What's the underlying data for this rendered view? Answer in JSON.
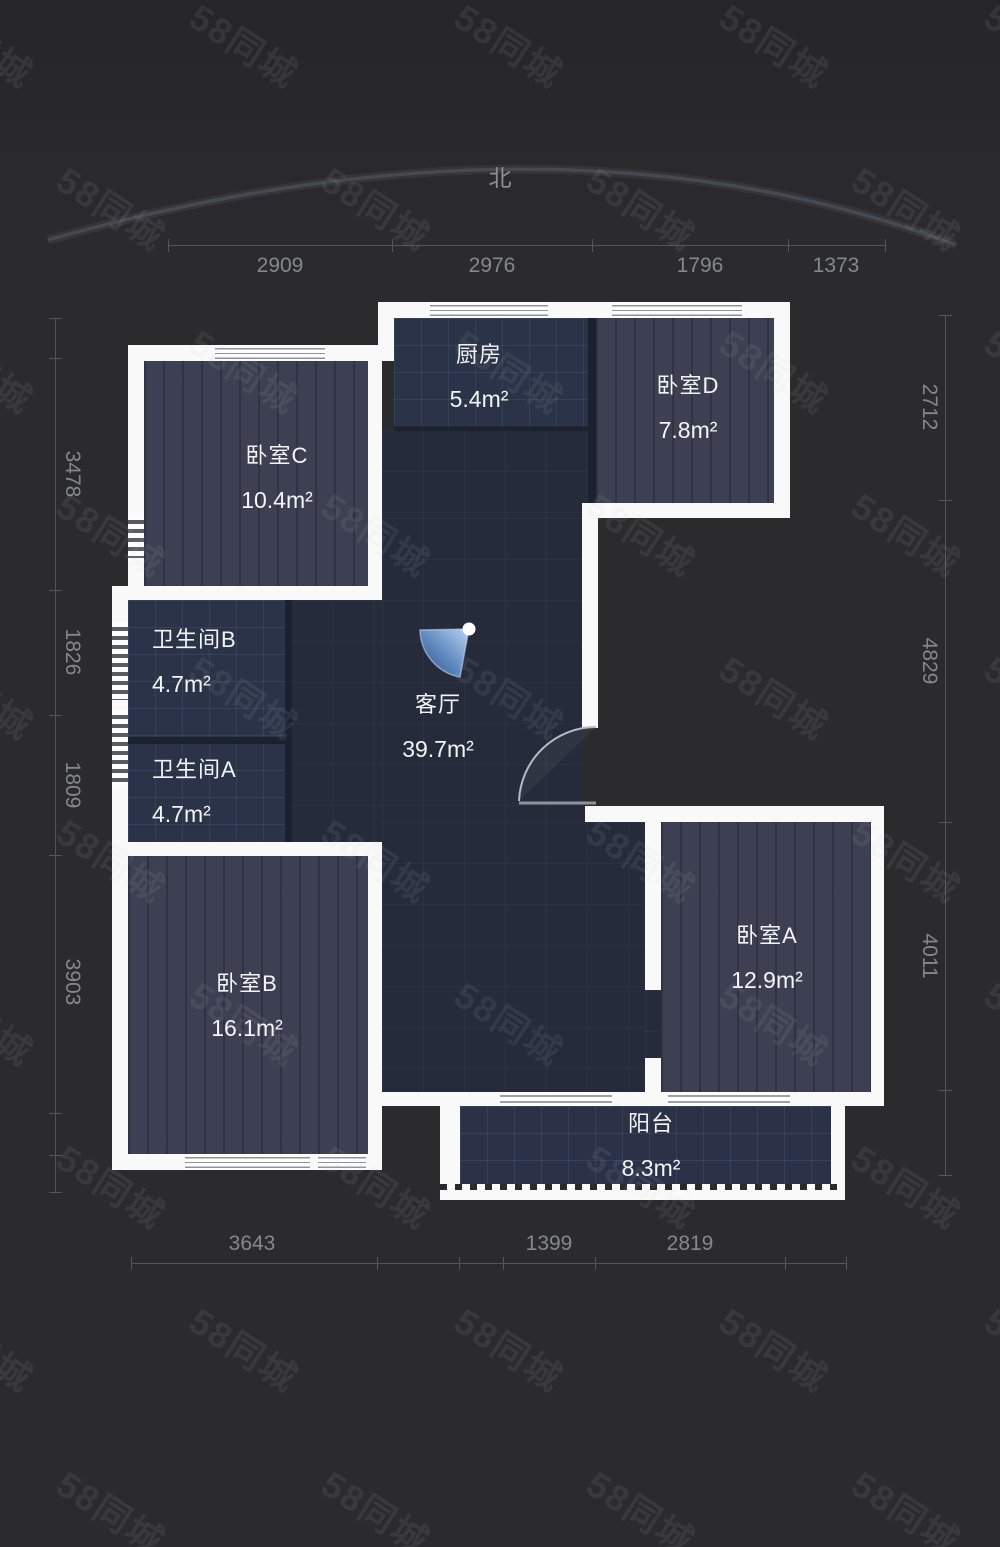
{
  "page": {
    "background": "#2b2b2e"
  },
  "north": {
    "label": "北"
  },
  "watermark": {
    "text": "58同城"
  },
  "rooms": {
    "kitchen": {
      "name": "厨房",
      "area": "5.4m²"
    },
    "bedroom_d": {
      "name": "卧室D",
      "area": "7.8m²"
    },
    "bedroom_c": {
      "name": "卧室C",
      "area": "10.4m²"
    },
    "bathroom_b": {
      "name": "卫生间B",
      "area": "4.7m²"
    },
    "bathroom_a": {
      "name": "卫生间A",
      "area": "4.7m²"
    },
    "living_room": {
      "name": "客厅",
      "area": "39.7m²"
    },
    "bedroom_b": {
      "name": "卧室B",
      "area": "16.1m²"
    },
    "bedroom_a": {
      "name": "卧室A",
      "area": "12.9m²"
    },
    "balcony": {
      "name": "阳台",
      "area": "8.3m²"
    }
  },
  "dimensions": [
    {
      "id": "top",
      "dir": "h",
      "pos": 245,
      "from": 168,
      "to": 885,
      "ticks": [
        168,
        392,
        592,
        788,
        885
      ],
      "label_side": "below",
      "labels": [
        {
          "text": "2909",
          "at": 280
        },
        {
          "text": "2976",
          "at": 492
        },
        {
          "text": "1796",
          "at": 700
        },
        {
          "text": "1373",
          "at": 836
        }
      ]
    },
    {
      "id": "bottom",
      "dir": "h",
      "pos": 1263,
      "from": 131,
      "to": 846,
      "ticks": [
        131,
        377,
        459,
        503,
        595,
        785,
        846
      ],
      "label_side": "above",
      "labels": [
        {
          "text": "3643",
          "at": 252
        },
        {
          "text": "1399",
          "at": 549
        },
        {
          "text": "2819",
          "at": 690
        }
      ]
    },
    {
      "id": "left",
      "dir": "v",
      "pos": 55,
      "from": 318,
      "to": 1192,
      "ticks": [
        318,
        358,
        590,
        715,
        855,
        1113,
        1155,
        1192
      ],
      "label_side": "right",
      "labels": [
        {
          "text": "3478",
          "at": 474
        },
        {
          "text": "1826",
          "at": 652
        },
        {
          "text": "1809",
          "at": 785
        },
        {
          "text": "3903",
          "at": 982
        }
      ]
    },
    {
      "id": "right",
      "dir": "v",
      "pos": 945,
      "from": 315,
      "to": 1175,
      "ticks": [
        315,
        500,
        822,
        1090,
        1175
      ],
      "label_side": "left",
      "labels": [
        {
          "text": "2712",
          "at": 407
        },
        {
          "text": "4829",
          "at": 661
        },
        {
          "text": "4011",
          "at": 956
        }
      ]
    }
  ],
  "colors": {
    "wall": "#f9f9f9",
    "bedroom_floor": "#3d4052",
    "tile_floor": "#2a3347",
    "living_floor": "#252b3a",
    "viewpoint_blue": "#4a74b0",
    "dimension_text": "#86878d",
    "watermark_text": "#c8cbd2"
  }
}
